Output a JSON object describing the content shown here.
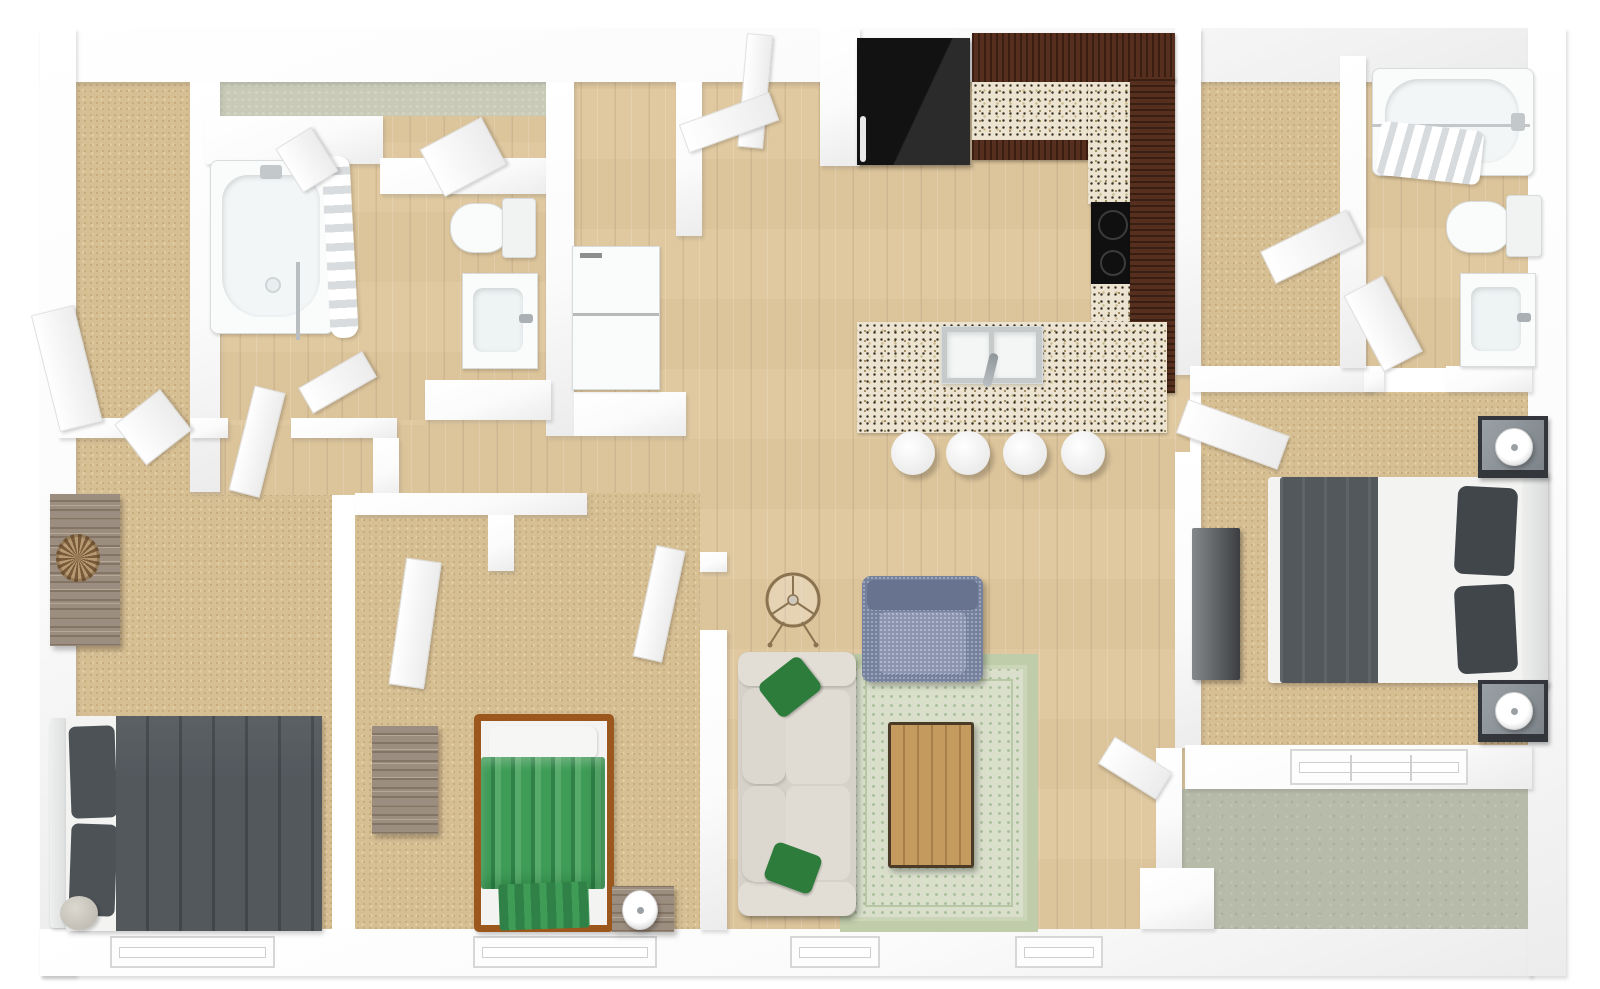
{
  "scene": {
    "title": "3D apartment floor plan, top-down dollhouse render",
    "render_style": "photoreal 3D floor plan on white background",
    "visible_text": []
  },
  "palette": {
    "wall": "#fbfbfb",
    "wallShade": "#ececec",
    "wallEdge": "#e0e0e0",
    "carpet": "#d7bf94",
    "carpetDot": "#c7ab7c",
    "carpetLite": "#e6d5ae",
    "wood": "#e0c9a0",
    "woodGrain": "#c9ad7e",
    "woodLite": "#ecdcba",
    "laundryFloor": "#c9cbb8",
    "patioFloor": "#b7bba9",
    "granite": "#ece4d0",
    "graniteDark": "#332d22",
    "graniteTan": "#a08c5e",
    "graniteMid": "#cdbd92",
    "cabinet": "#572f1f",
    "cabinetGrain": "#3a1e12",
    "appliance": "#161616",
    "fixture": "#fafbfb",
    "fixtureEdge": "#d9dcdd",
    "basin": "#eef3f4",
    "metal": "#a7adb0",
    "sofa": "#d6d2c9",
    "sofaLite": "#e2ded6",
    "pillowGreen": "#2e7c3c",
    "armchair": "#76819d",
    "armchairLite": "#8b95b0",
    "armchairDark": "#67738f",
    "rugField": "#d9dfcb",
    "rugBorder": "#bfcdaa",
    "rugDot": "#aabf9b",
    "tableWood": "#c49a5f",
    "tableWoodDark": "#a87f49",
    "bedDark": "#53585d",
    "bedDarker": "#41464b",
    "mattress": "#f3f3f1",
    "bedGreen": "#3f9c57",
    "bedGreenDark": "#2f8147",
    "bedGreenLite": "#57ab6b",
    "bedFrame": "#9c581c",
    "rustic": "#9b8d7f",
    "rusticDark": "#6f6152",
    "rusticLite": "#b5a896",
    "nightstand": "#33363a",
    "nightTop": "#8f969b"
  },
  "rooms": [
    {
      "id": "bedroom-bottom-left",
      "floor": "carpet",
      "contents": [
        "double-bed-dark-gray",
        "rustic-dresser",
        "potted-plant",
        "round-ottoman",
        "reach-in-closet"
      ]
    },
    {
      "id": "bathroom-left",
      "floor": "wood",
      "contents": [
        "bathtub-with-shower-curtain",
        "toilet",
        "sink-vanity"
      ]
    },
    {
      "id": "laundry-room",
      "floor": "green-vinyl",
      "contents": [
        "stacked-washer-dryer-closet"
      ]
    },
    {
      "id": "bedroom-middle",
      "floor": "carpet",
      "contents": [
        "twin-bed-green-striped",
        "rustic-dresser",
        "nightstand-with-lamp",
        "closet"
      ]
    },
    {
      "id": "kitchen",
      "floor": "wood",
      "contents": [
        "black-refrigerator",
        "l-shaped-dark-wood-cabinets",
        "granite-countertop",
        "black-cooktop",
        "island-with-double-sink",
        "bar-stools-x4"
      ]
    },
    {
      "id": "living-room",
      "floor": "wood",
      "contents": [
        "cream-sofa-with-green-pillows",
        "blue-gray-armchair",
        "green-area-rug",
        "wood-coffee-table",
        "round-decor-stand"
      ]
    },
    {
      "id": "walk-in-closet-top-right",
      "floor": "carpet",
      "contents": []
    },
    {
      "id": "bathroom-right",
      "floor": "wood",
      "contents": [
        "bathtub-with-shower-curtain",
        "toilet",
        "sink-vanity"
      ]
    },
    {
      "id": "master-bedroom",
      "floor": "carpet",
      "contents": [
        "queen-bed-dark-gray",
        "nightstand-with-lamp-x2",
        "gray-dresser"
      ]
    },
    {
      "id": "patio",
      "floor": "concrete",
      "contents": []
    }
  ],
  "counts": {
    "bar_stools": 4,
    "bottom_wall_windows": 4,
    "patio_window_panes": 3,
    "interior_doors": 14
  }
}
